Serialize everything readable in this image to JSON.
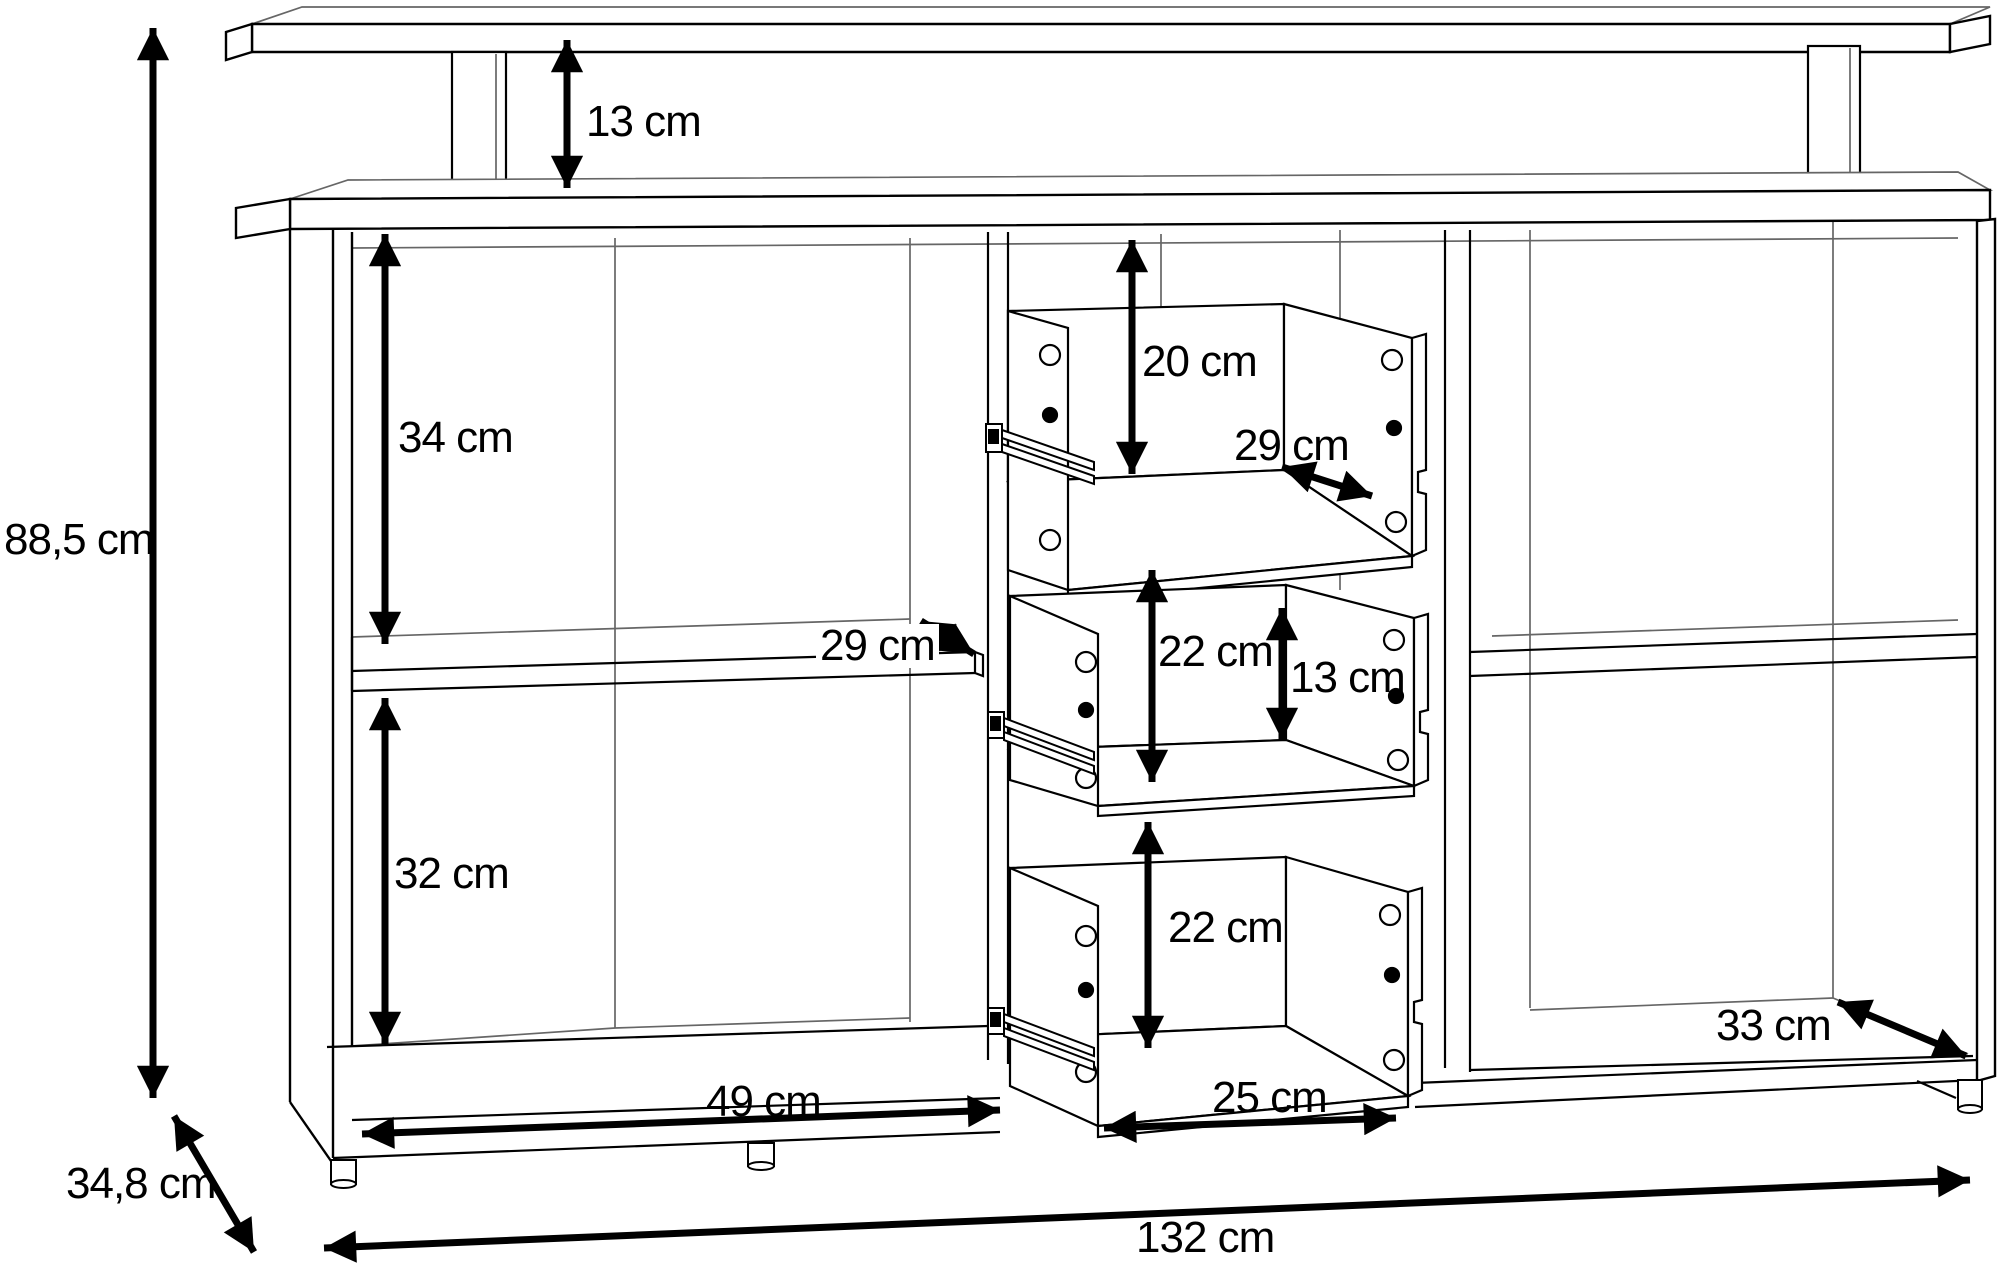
{
  "unit": "cm",
  "colors": {
    "background": "#ffffff",
    "line": "#000000",
    "subtle_line": "#666666"
  },
  "dimensions": {
    "overall_height": "88,5 cm",
    "hutch_shelf_clearance": "13 cm",
    "upper_left_section_height": "34 cm",
    "lower_left_section_height": "32 cm",
    "left_shelf_depth": "29 cm",
    "top_drawer_height": "20 cm",
    "top_drawer_depth": "29 cm",
    "middle_drawer_height": "22 cm",
    "middle_drawer_back_height": "13 cm",
    "bottom_drawer_height": "22 cm",
    "left_section_width": "49 cm",
    "drawer_width": "25 cm",
    "right_section_depth": "33 cm",
    "overall_depth": "34,8 cm",
    "overall_width": "132 cm"
  }
}
